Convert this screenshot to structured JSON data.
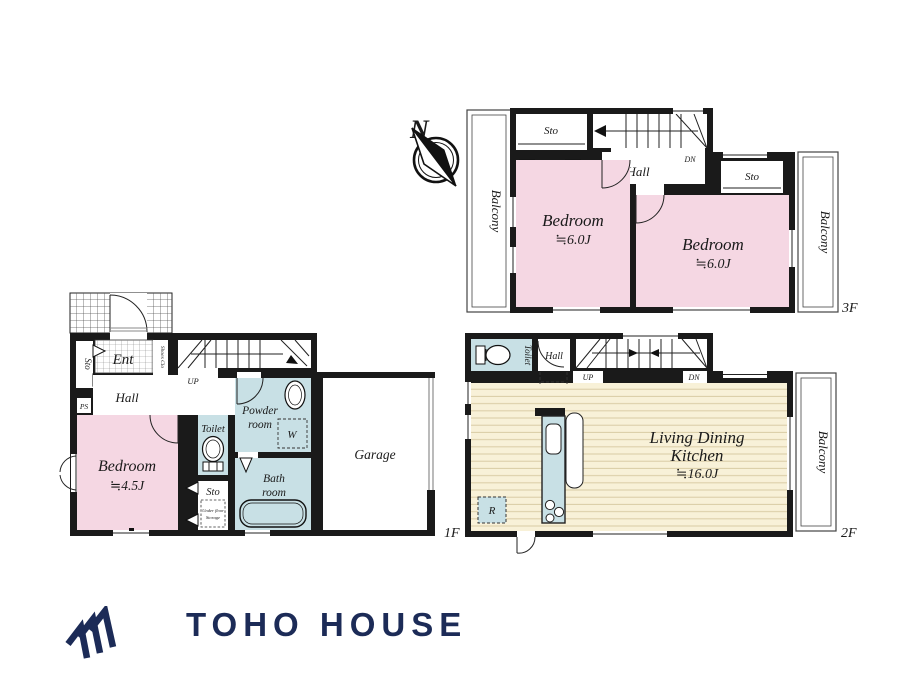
{
  "compass": {
    "north": "N"
  },
  "colors": {
    "wall": "#1a1a1a",
    "outline": "#444444",
    "room_pink": "#f5d7e3",
    "room_blue": "#c8e0e5",
    "ldk_cream": "#f8f1d8",
    "floor_line": "#d9cba4",
    "tile_line": "#555555",
    "tile_line_light": "#8a8a8a",
    "brand_navy": "#1c2b57"
  },
  "floor3": {
    "label": "3F",
    "balcony_left": "Balcony",
    "balcony_right": "Balcony",
    "sto_left": "Sto",
    "sto_right": "Sto",
    "hall": "Hall",
    "dn": "DN",
    "bedroom_left_name": "Bedroom",
    "bedroom_left_size": "≒6.0J",
    "bedroom_right_name": "Bedroom",
    "bedroom_right_size": "≒6.0J"
  },
  "floor2": {
    "label": "2F",
    "balcony": "Balcony",
    "toilet": "Toilet",
    "hall": "Hall",
    "up": "UP",
    "dn": "DN",
    "ldk_line1": "Living Dining",
    "ldk_line2": "Kitchen",
    "ldk_size": "≒16.0J",
    "fridge": "R"
  },
  "floor1": {
    "label": "1F",
    "ent": "Ent",
    "shoes_clo": "Shoes Clo",
    "sto_upper": "Sto",
    "ps": "PS",
    "hall": "Hall",
    "up": "UP",
    "bedroom_name": "Bedroom",
    "bedroom_size": "≒4.5J",
    "toilet": "Toilet",
    "sto_lower": "Sto",
    "underfloor_line1": "Under floor",
    "underfloor_line2": "Storage",
    "powder_line1": "Powder",
    "powder_line2": "room",
    "washer": "W",
    "bath_line1": "Bath",
    "bath_line2": "room",
    "garage": "Garage"
  },
  "brand": {
    "name": "TOHO HOUSE"
  }
}
